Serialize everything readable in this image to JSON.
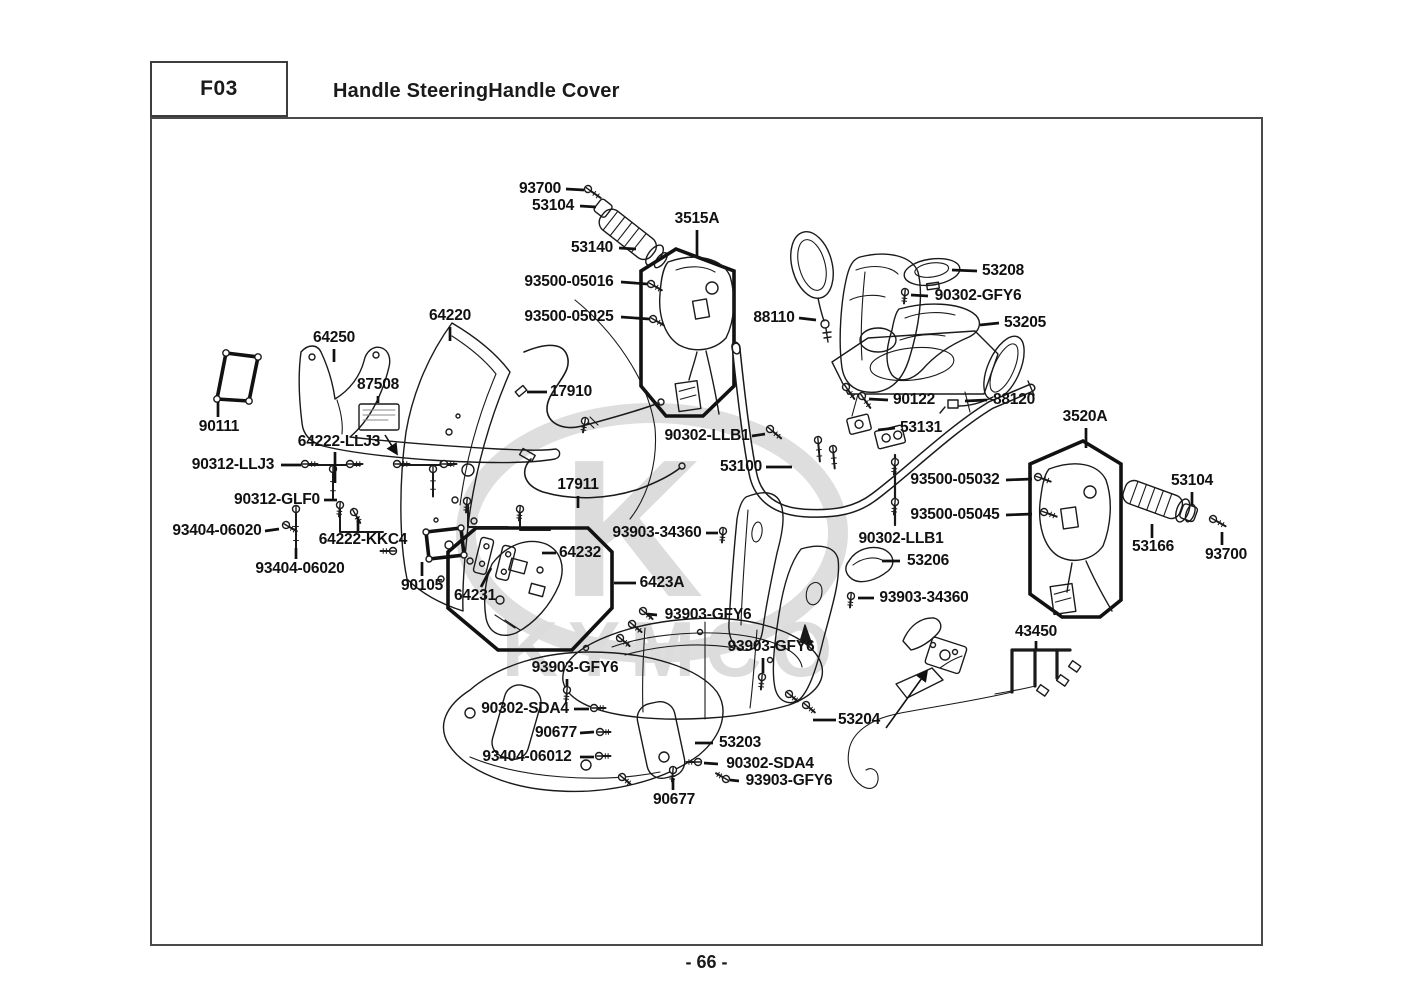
{
  "header": {
    "code": "F03",
    "title": "Handle SteeringHandle Cover"
  },
  "footer": {
    "page_number": "- 66 -"
  },
  "watermark": {
    "letter": "K",
    "text": "KYMCO"
  },
  "parts": [
    {
      "label": "93700",
      "x": 540,
      "y": 189,
      "leader": [
        [
          566,
          189
        ],
        [
          584,
          190
        ]
      ]
    },
    {
      "label": "53104",
      "x": 553,
      "y": 206,
      "leader": [
        [
          580,
          206
        ],
        [
          596,
          207
        ]
      ]
    },
    {
      "label": "53140",
      "x": 592,
      "y": 248,
      "leader": [
        [
          619,
          248
        ],
        [
          636,
          249
        ]
      ]
    },
    {
      "label": "3515A",
      "x": 697,
      "y": 219,
      "leader": [
        [
          697,
          230
        ],
        [
          697,
          256
        ]
      ]
    },
    {
      "label": "93500-05016",
      "x": 569,
      "y": 282,
      "leader": [
        [
          621,
          282
        ],
        [
          647,
          284
        ]
      ]
    },
    {
      "label": "93500-05025",
      "x": 569,
      "y": 317,
      "leader": [
        [
          621,
          317
        ],
        [
          649,
          319
        ]
      ]
    },
    {
      "label": "88110",
      "x": 774,
      "y": 318,
      "leader": [
        [
          799,
          318
        ],
        [
          816,
          320
        ]
      ]
    },
    {
      "label": "53208",
      "x": 1003,
      "y": 271,
      "leader": [
        [
          977,
          271
        ],
        [
          952,
          270
        ]
      ]
    },
    {
      "label": "90302-GFY6",
      "x": 978,
      "y": 296,
      "leader": [
        [
          928,
          296
        ],
        [
          911,
          295
        ]
      ]
    },
    {
      "label": "53205",
      "x": 1025,
      "y": 323,
      "leader": [
        [
          999,
          323
        ],
        [
          980,
          325
        ]
      ]
    },
    {
      "label": "64220",
      "x": 450,
      "y": 316,
      "leader": [
        [
          450,
          327
        ],
        [
          450,
          341
        ]
      ]
    },
    {
      "label": "64250",
      "x": 334,
      "y": 338,
      "leader": [
        [
          334,
          349
        ],
        [
          334,
          362
        ]
      ]
    },
    {
      "label": "87508",
      "x": 378,
      "y": 385,
      "leader": [
        [
          378,
          396
        ],
        [
          378,
          403
        ]
      ]
    },
    {
      "label": "17910",
      "x": 571,
      "y": 392,
      "leader": [
        [
          547,
          392
        ],
        [
          527,
          392
        ]
      ]
    },
    {
      "label": "90111",
      "x": 219,
      "y": 427,
      "leader": [
        [
          218,
          417
        ],
        [
          218,
          402
        ]
      ]
    },
    {
      "label": "64222-LLJ3",
      "x": 339,
      "y": 442,
      "leader": [
        [
          335,
          452
        ],
        [
          335,
          483
        ]
      ],
      "arrow": [
        [
          385,
          435
        ],
        [
          397,
          454
        ]
      ]
    },
    {
      "label": "90312-LLJ3",
      "x": 233,
      "y": 465,
      "leader": [
        [
          281,
          465
        ],
        [
          301,
          465
        ]
      ]
    },
    {
      "label": "90312-GLF0",
      "x": 277,
      "y": 500,
      "leader": [
        [
          324,
          500
        ],
        [
          337,
          500
        ]
      ]
    },
    {
      "label": "93404-06020",
      "x": 217,
      "y": 531,
      "leader": [
        [
          265,
          531
        ],
        [
          279,
          529
        ]
      ]
    },
    {
      "label": "64222-KKC4",
      "x": 363,
      "y": 540,
      "leader": [
        [
          358,
          531
        ],
        [
          358,
          517
        ]
      ]
    },
    {
      "label": "93404-06020",
      "x": 300,
      "y": 569,
      "leader": [
        [
          296,
          559
        ],
        [
          296,
          548
        ]
      ]
    },
    {
      "label": "90105",
      "x": 422,
      "y": 586,
      "leader": [
        [
          422,
          576
        ],
        [
          422,
          562
        ]
      ]
    },
    {
      "label": "64231",
      "x": 475,
      "y": 596,
      "leader": [
        [
          481,
          587
        ],
        [
          491,
          568
        ]
      ]
    },
    {
      "label": "64232",
      "x": 580,
      "y": 553,
      "leader": [
        [
          556,
          553
        ],
        [
          542,
          553
        ]
      ]
    },
    {
      "label": "6423A",
      "x": 662,
      "y": 583,
      "leader": [
        [
          636,
          583
        ],
        [
          614,
          583
        ]
      ]
    },
    {
      "label": "93903-34360",
      "x": 657,
      "y": 533,
      "leader": [
        [
          706,
          533
        ],
        [
          718,
          533
        ]
      ]
    },
    {
      "label": "90302-LLB1",
      "x": 707,
      "y": 436,
      "leader": [
        [
          752,
          436
        ],
        [
          765,
          434
        ]
      ]
    },
    {
      "label": "53100",
      "x": 741,
      "y": 467,
      "leader": [
        [
          766,
          467
        ],
        [
          792,
          467
        ]
      ]
    },
    {
      "label": "17911",
      "x": 578,
      "y": 485,
      "leader": [
        [
          578,
          496
        ],
        [
          578,
          508
        ]
      ]
    },
    {
      "label": "90122",
      "x": 914,
      "y": 400,
      "leader": [
        [
          888,
          400
        ],
        [
          869,
          399
        ]
      ]
    },
    {
      "label": "88120",
      "x": 1014,
      "y": 400,
      "leader": [
        [
          987,
          400
        ],
        [
          965,
          401
        ]
      ]
    },
    {
      "label": "53131",
      "x": 921,
      "y": 428,
      "leader": [
        [
          895,
          428
        ],
        [
          878,
          430
        ]
      ]
    },
    {
      "label": "3520A",
      "x": 1085,
      "y": 417,
      "leader": [
        [
          1086,
          428
        ],
        [
          1086,
          448
        ]
      ]
    },
    {
      "label": "93500-05032",
      "x": 955,
      "y": 480,
      "leader": [
        [
          1006,
          480
        ],
        [
          1032,
          479
        ]
      ]
    },
    {
      "label": "93500-05045",
      "x": 955,
      "y": 515,
      "leader": [
        [
          1006,
          515
        ],
        [
          1032,
          514
        ]
      ]
    },
    {
      "label": "90302-LLB1",
      "x": 901,
      "y": 539
    },
    {
      "label": "53206",
      "x": 928,
      "y": 561,
      "leader": [
        [
          900,
          561
        ],
        [
          882,
          561
        ]
      ]
    },
    {
      "label": "93903-34360",
      "x": 924,
      "y": 598,
      "leader": [
        [
          874,
          598
        ],
        [
          858,
          598
        ]
      ]
    },
    {
      "label": "53104",
      "x": 1192,
      "y": 481,
      "leader": [
        [
          1192,
          492
        ],
        [
          1192,
          505
        ]
      ]
    },
    {
      "label": "53166",
      "x": 1153,
      "y": 547,
      "leader": [
        [
          1152,
          538
        ],
        [
          1152,
          524
        ]
      ]
    },
    {
      "label": "93700",
      "x": 1226,
      "y": 555,
      "leader": [
        [
          1222,
          545
        ],
        [
          1222,
          532
        ]
      ]
    },
    {
      "label": "43450",
      "x": 1036,
      "y": 632,
      "leader": [
        [
          1036,
          641
        ],
        [
          1036,
          649
        ]
      ]
    },
    {
      "label": "93903-GFY6",
      "x": 708,
      "y": 615,
      "leader": [
        [
          657,
          615
        ],
        [
          647,
          614
        ]
      ]
    },
    {
      "label": "93903-GFY6",
      "x": 771,
      "y": 647,
      "leader": [
        [
          763,
          658
        ],
        [
          763,
          673
        ]
      ]
    },
    {
      "label": "93903-GFY6",
      "x": 575,
      "y": 668,
      "leader": [
        [
          567,
          679
        ],
        [
          567,
          686
        ]
      ]
    },
    {
      "label": "90302-SDA4",
      "x": 525,
      "y": 709,
      "leader": [
        [
          574,
          709
        ],
        [
          589,
          709
        ]
      ]
    },
    {
      "label": "90677",
      "x": 556,
      "y": 733,
      "leader": [
        [
          580,
          733
        ],
        [
          594,
          732
        ]
      ]
    },
    {
      "label": "93404-06012",
      "x": 527,
      "y": 757,
      "leader": [
        [
          580,
          757
        ],
        [
          594,
          757
        ]
      ]
    },
    {
      "label": "53203",
      "x": 740,
      "y": 743,
      "leader": [
        [
          713,
          743
        ],
        [
          695,
          743
        ]
      ]
    },
    {
      "label": "90302-SDA4",
      "x": 770,
      "y": 764,
      "leader": [
        [
          718,
          764
        ],
        [
          704,
          763
        ]
      ]
    },
    {
      "label": "93903-GFY6",
      "x": 789,
      "y": 781,
      "leader": [
        [
          739,
          781
        ],
        [
          730,
          780
        ]
      ]
    },
    {
      "label": "90677",
      "x": 674,
      "y": 800,
      "leader": [
        [
          673,
          790
        ],
        [
          673,
          778
        ]
      ]
    },
    {
      "label": "53204",
      "x": 859,
      "y": 720,
      "leader": [
        [
          836,
          720
        ],
        [
          813,
          720
        ]
      ],
      "arrow": [
        [
          886,
          728
        ],
        [
          927,
          671
        ]
      ]
    }
  ]
}
